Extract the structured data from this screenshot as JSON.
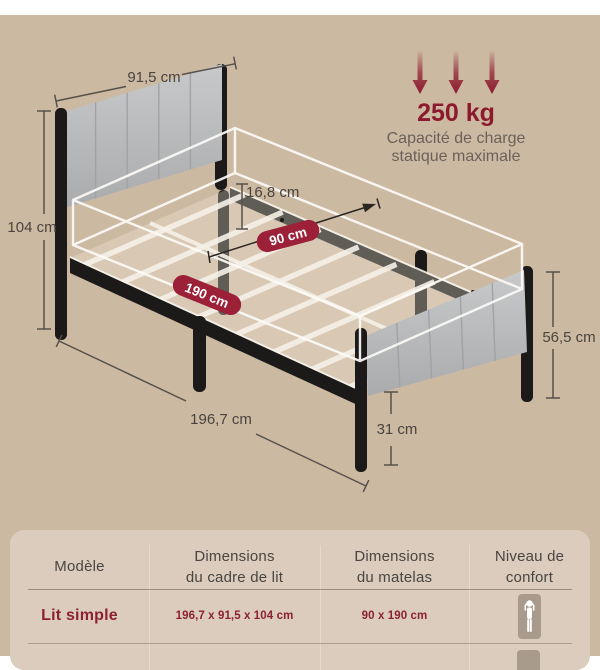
{
  "colors": {
    "background": "#ccb9a2",
    "top_strip": "#ffffff",
    "accent_red": "#8c1a2e",
    "pill_red": "#9b2038",
    "frame_black": "#1b1a18",
    "upholstery_gray": "#b5b7b9",
    "measure_line": "#56514b",
    "measure_text": "#4a443e",
    "caption_gray": "#6a615a",
    "table_bg": "#dbccbe",
    "table_header_text": "#4a4540",
    "table_value_red": "#8c2132",
    "comfort_icon_bg": "#a89a8c"
  },
  "capacity": {
    "value": "250 kg",
    "caption1": "Capacité de charge",
    "caption2": "statique maximale"
  },
  "dims": {
    "headboard_width": "91,5 cm",
    "total_height": "104 cm",
    "side_height": "16,8 cm",
    "mattress_width": "90 cm",
    "mattress_length": "190 cm",
    "frame_length": "196,7 cm",
    "footboard_height": "56,5 cm",
    "under_bed_clearance": "31 cm"
  },
  "table": {
    "headers": [
      {
        "line1": "Modèle",
        "line2": ""
      },
      {
        "line1": "Dimensions",
        "line2": "du cadre de lit"
      },
      {
        "line1": "Dimensions",
        "line2": "du matelas"
      },
      {
        "line1": "Niveau de",
        "line2": "confort"
      }
    ],
    "rows": [
      {
        "model": "Lit simple",
        "frame_dimensions": "196,7 x 91,5 x 104 cm",
        "mattress_dimensions": "90 x 190 cm",
        "comfort_icon": "person-lying-icon"
      }
    ]
  }
}
